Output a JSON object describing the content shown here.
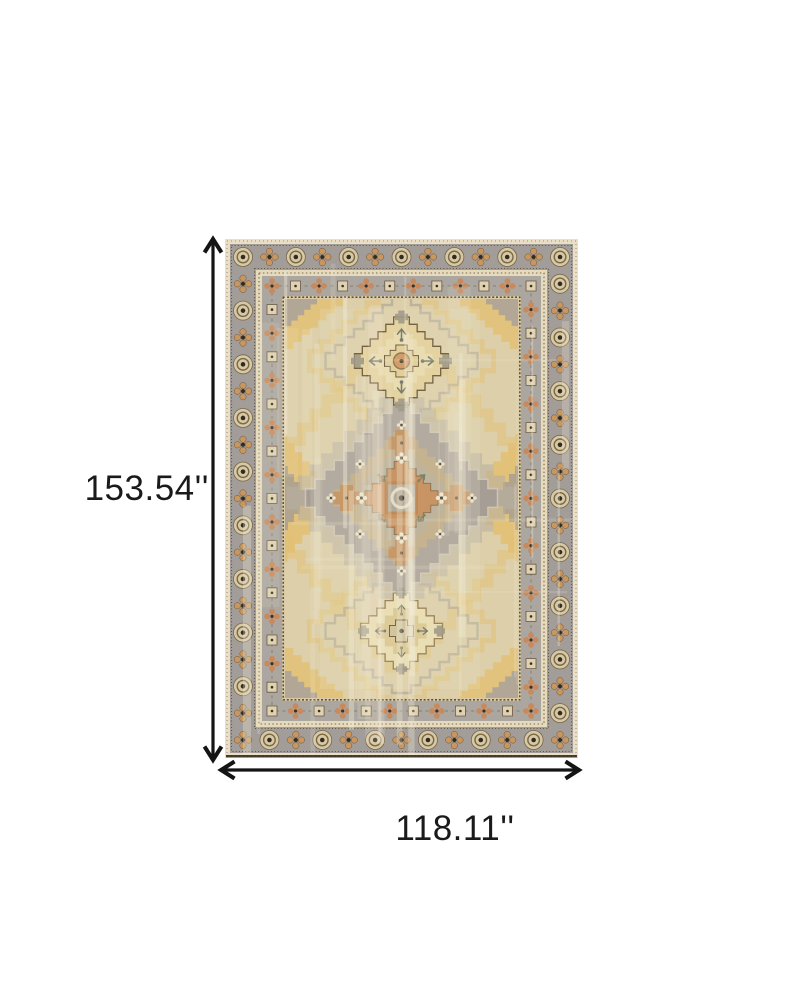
{
  "figure": {
    "background": "#ffffff",
    "subject": "distressed medallion area rug"
  },
  "dimensions": {
    "height_label": "153.54''",
    "width_label": "118.11''"
  },
  "icons": {
    "height_arrow": "double-headed-vertical-arrow-icon",
    "width_arrow": "double-headed-horizontal-arrow-icon"
  },
  "colors": {
    "page_background": "#ffffff",
    "dimension_line": "#141414",
    "label_text": "#1a1a1a",
    "rug_edge_cream": "#eadfc4",
    "rug_border_gray": "#a29d99",
    "rug_border_gray_light": "#aba69f",
    "rug_guard_cream": "#e6dabd",
    "rug_field": "#dccfa9",
    "rug_gold": "#e2bf72",
    "rug_medallion_gold": "#e2cf96",
    "rug_medallion_cream": "#e9dcb0",
    "rug_orange": "#c0824c",
    "rug_tan": "#bfa981",
    "rug_center_gray": "#a59d96",
    "rug_brown": "#5d4a32",
    "rug_dark": "#352b1d",
    "rug_teal": "#5c6e55"
  }
}
